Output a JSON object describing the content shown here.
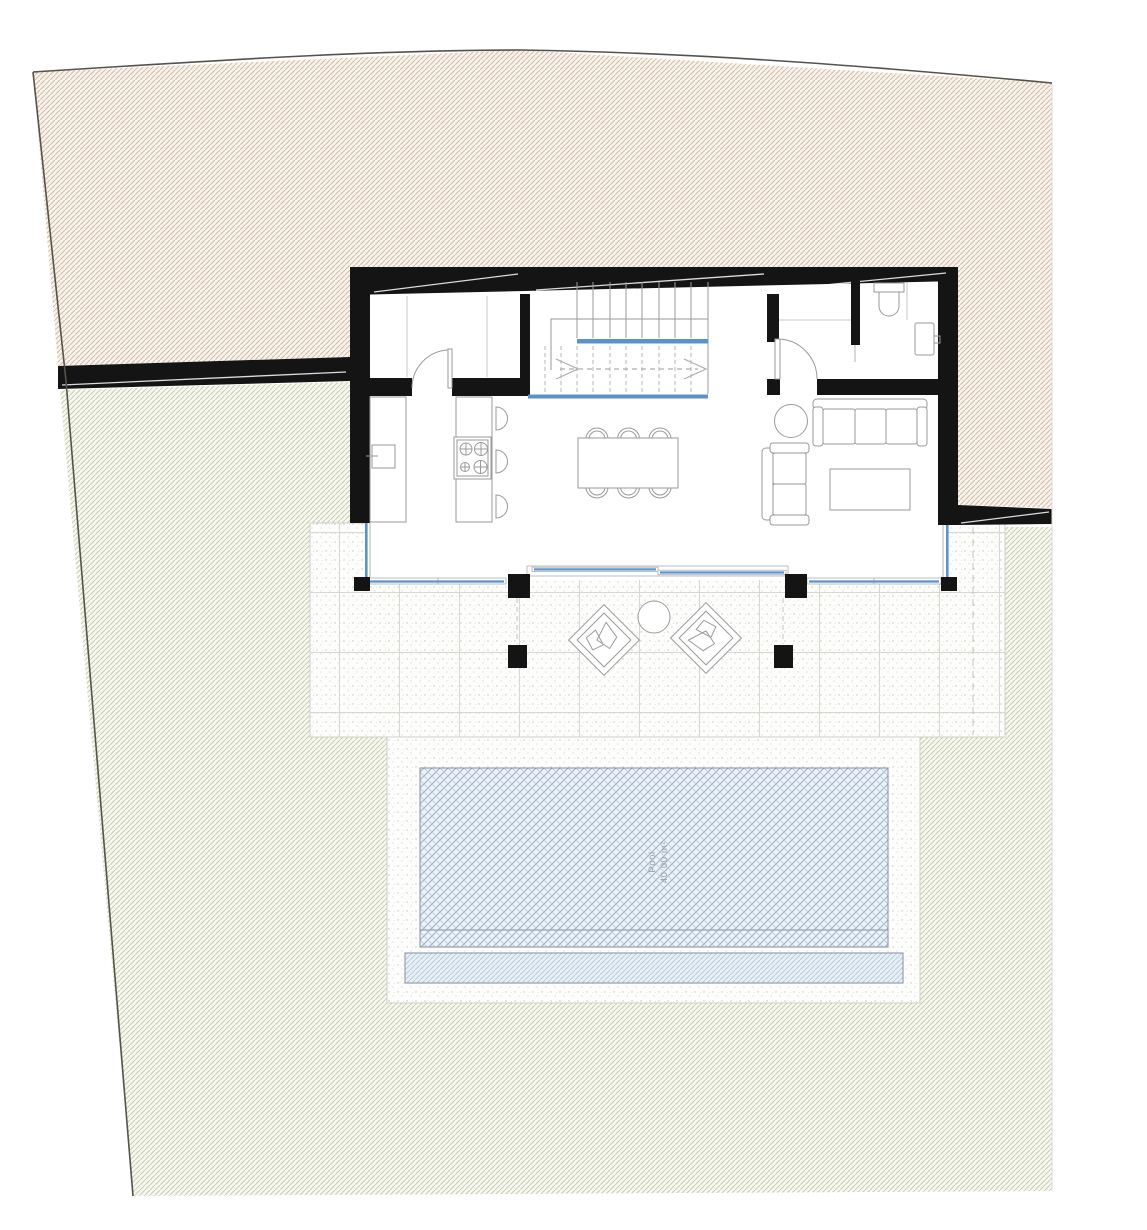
{
  "plan": {
    "type": "architectural-site-plan",
    "pool_label": {
      "line1": "Pool",
      "line2": "40.00 m²"
    }
  },
  "colors": {
    "wall": "#141414",
    "glazing_blue": "#5b93c8",
    "boundary_line": "#55524b",
    "furniture_line": "#9a9a9a",
    "terrain_upper_bg": "#f8f3ed",
    "terrain_upper_hatch": "#d2bca7",
    "garden_bg": "#f7f8f1",
    "garden_hatch": "#c8cdb0",
    "pool_bg": "#edf3f8",
    "pool_lattice_dark": "#9db1c2",
    "pool_lattice_light": "#c0d2e0",
    "overflow_bg": "#e9f0f6",
    "overflow_hatch": "#b7c9d9",
    "tile_grid": "#d8d8d3"
  }
}
